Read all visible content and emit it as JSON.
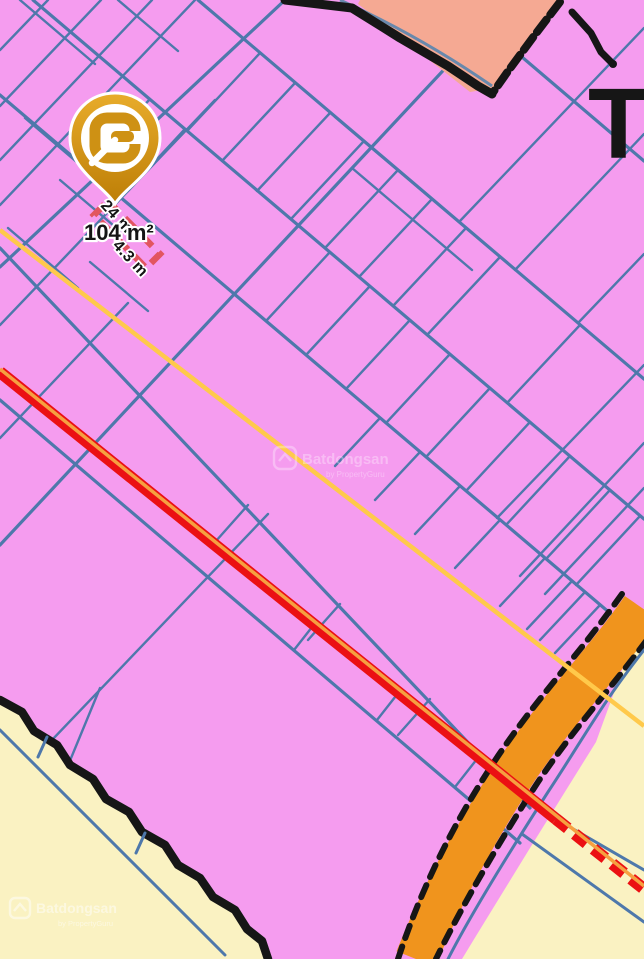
{
  "map": {
    "marker": {
      "logo_letter": "G",
      "area_label": "104 m²",
      "length_label": "24 m",
      "width_label": "4.3 m"
    },
    "street_label": "T",
    "watermark": {
      "brand": "Batdongsan",
      "byline": "by PropertyGuru"
    },
    "colors": {
      "parcel-pink": "#F59CEF",
      "parcel-line": "#4E78AB",
      "zone-cream": "#FAF2C2",
      "zone-salmon": "#F5A993",
      "road-orange": "#F0941D",
      "road-red": "#EB1013",
      "road-red-center": "#F6A040",
      "line-yellow": "#FFC94B",
      "ink-black": "#161616",
      "pin-gold": "#D59A18",
      "highlight-red": "#E25560"
    }
  }
}
